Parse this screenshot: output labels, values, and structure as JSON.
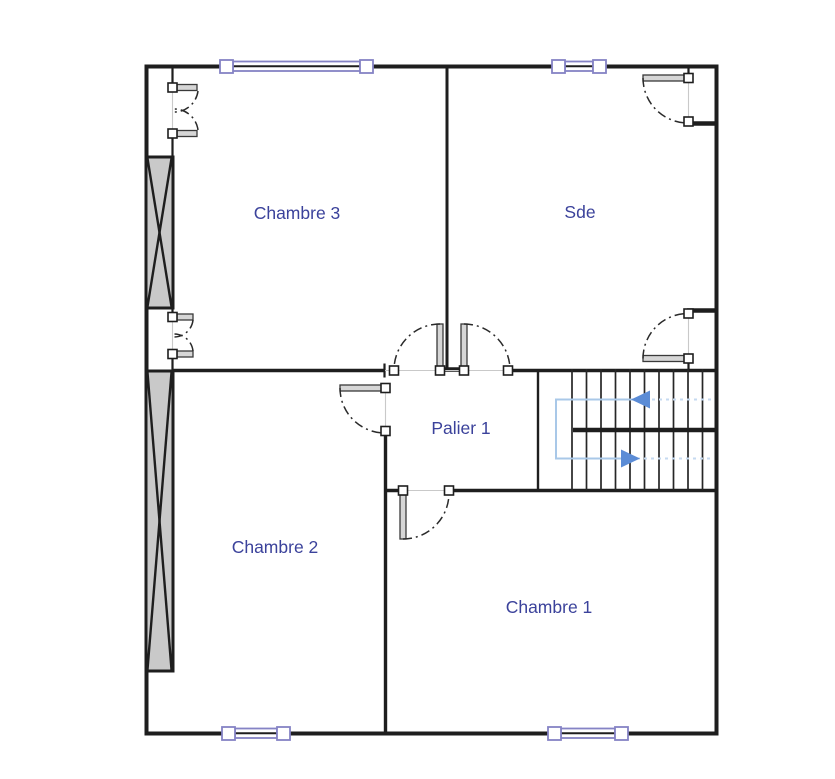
{
  "document": {
    "type": "architectural-floor-plan",
    "background": "#ffffff"
  },
  "palette": {
    "wall": "#1e1e1e",
    "window": "#8583c5",
    "label": "#3b429b",
    "chimney": "#c9c9c9",
    "door_leaf": "#d6d6d6",
    "stair_arrow": "#5b8cd6",
    "stair_path": "#a9c8e8",
    "stair_path_faint": "#c6daf0"
  },
  "rooms": [
    {
      "name": "chambre-3",
      "label": "Chambre 3"
    },
    {
      "name": "sde",
      "label": "Sde"
    },
    {
      "name": "palier-1",
      "label": "Palier 1"
    },
    {
      "name": "chambre-2",
      "label": "Chambre 2"
    },
    {
      "name": "chambre-1",
      "label": "Chambre 1"
    }
  ],
  "staircase": {
    "flights": 2,
    "upper_flight_arrow": "left",
    "lower_flight_arrow": "right"
  },
  "counts": {
    "windows": 4,
    "door_swings": 8,
    "hatched_chimney_blocks": 2
  }
}
